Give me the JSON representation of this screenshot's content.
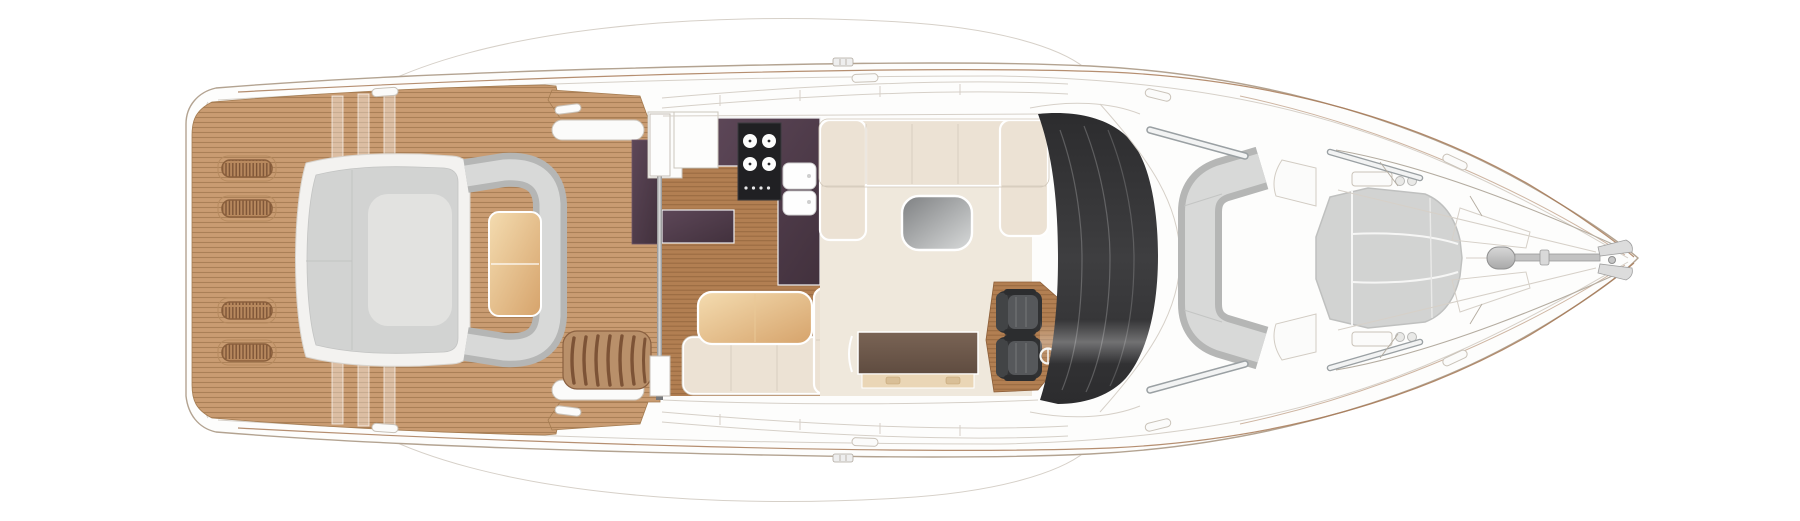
{
  "diagram": {
    "type": "yacht-main-deck-floor-plan",
    "orientation": "bow-right-stern-left-top-view",
    "zones": [
      {
        "id": "swim-aft-deck",
        "label": "aft teak deck with four deck vents"
      },
      {
        "id": "aft-sunpad",
        "label": "aft sun pad lounge with c-shaped bench and teak table"
      },
      {
        "id": "flybridge-steps",
        "label": "curved steps to flybridge"
      },
      {
        "id": "patio-door",
        "label": "sliding cockpit door with track"
      },
      {
        "id": "galley",
        "label": "galley with hob, twin sinks and plum worktops"
      },
      {
        "id": "dinette",
        "label": "dinette with l-shaped sofa and table"
      },
      {
        "id": "salon",
        "label": "salon with u-shaped sofa, coffee table and sideboard"
      },
      {
        "id": "helm",
        "label": "twin helm seats on teak plinth with wheel"
      },
      {
        "id": "windshield",
        "label": "wrap-around dark windscreen"
      },
      {
        "id": "fore-lounge",
        "label": "forward cockpit c-shaped lounge seat"
      },
      {
        "id": "bow-sunpad",
        "label": "bow sun pad in three sections"
      },
      {
        "id": "foredeck",
        "label": "foredeck with windlass, anchor roller and pulpit"
      }
    ],
    "counts": {
      "deck_vents": 4,
      "hob_burners": 4,
      "galley_sinks": 2,
      "helm_seats": 2,
      "bow_sunpad_sections": 3,
      "mooring_cleats": 10
    }
  },
  "colors": {
    "hull_stroke": "#b3a391",
    "faint_line": "#d6d0c8",
    "sheer_line": "#a87a57",
    "teak_light": "#c99c72",
    "teak_light_stripe": "#aa8057",
    "teak_edge": "#a57c51",
    "teak_dark": "#b27f52",
    "teak_dark_stripe": "#986940",
    "teak_dark_edge": "#8c5e38",
    "vent_base": "#b8895e",
    "vent_slat": "#7c5336",
    "plum_light": "#5d4758",
    "plum_dark": "#42313d",
    "hob_black": "#202023",
    "cream": "#ece2d4",
    "cream_seam": "#d9cfc0",
    "carpet": "#efe8dc",
    "gray_pad": "#d2d3d2",
    "gray_pad_rim": "#b5b6b5",
    "gray_pad_cushion": "#d8d9d8",
    "gray_pad_light": "#e2e2e0",
    "table_tan_1": "#f4dcb0",
    "table_tan_2": "#d6a36b",
    "coffee_1": "#7e8082",
    "coffee_2": "#d8dada",
    "sideboard_1": "#7a6455",
    "sideboard_2": "#5f4c40",
    "sideboard_front": "#ead6b6",
    "seat_dark": "#313234",
    "seat_back": "#424446",
    "seat_mid": "#56585b",
    "windshield_1": "#2c2c2e",
    "windshield_2": "#3e3e40",
    "metal": "#9aa0a3",
    "track_silver": "#8e8f90"
  }
}
